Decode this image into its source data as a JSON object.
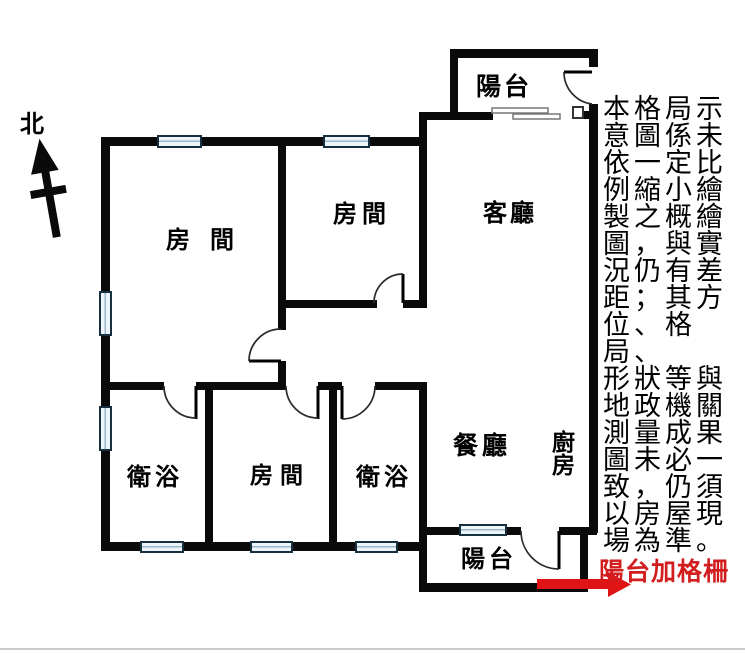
{
  "north": {
    "label": "北"
  },
  "rooms": {
    "room1": "房間",
    "room2": "房間",
    "living": "客廳",
    "bath1": "衛浴",
    "room3": "房間",
    "bath2": "衛浴",
    "dining": "餐廳",
    "kitchen": "廚房",
    "balcony_top": "陽台",
    "balcony_bottom": "陽台"
  },
  "disclaimer": {
    "text": "本格局示\n意圖係未\n依一定比\n例縮小繪\n製之概繪\n圖，與實\n況仍有差\n距；其方\n位、格局、\n形狀等與\n地政機關\n測量成果\n圖未必一\n致，仍須\n以房屋現\n場為準。"
  },
  "annotation": {
    "balcony_note": "陽台加格柵"
  },
  "colors": {
    "wall": "#0a0a0a",
    "window_border": "#16303f",
    "window_stripe": "#9db8c8",
    "red_text": "#d21e1e",
    "red_arrow": "#e01414",
    "divider": "#cccccc"
  }
}
